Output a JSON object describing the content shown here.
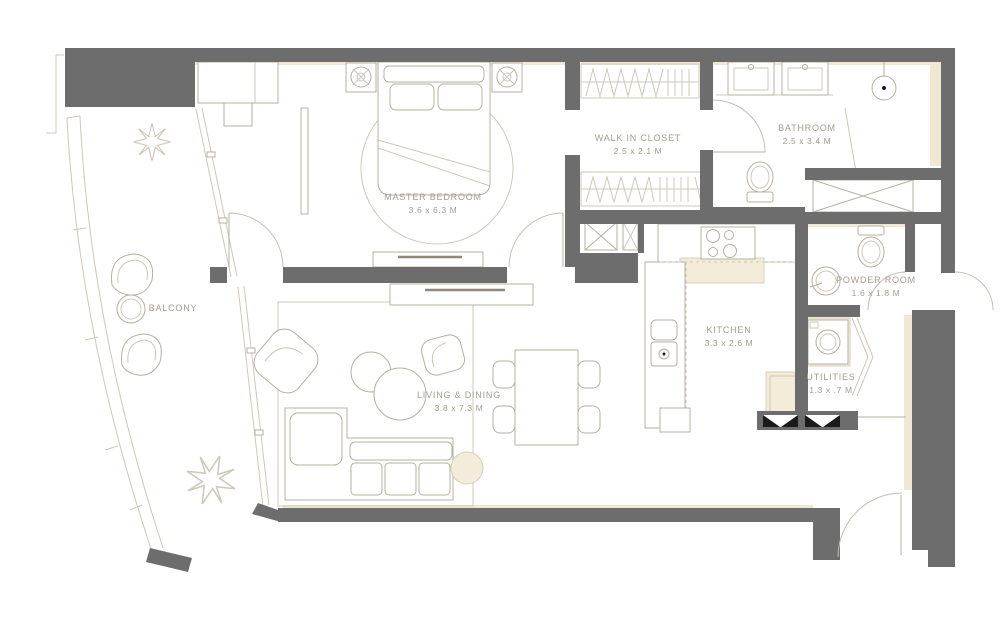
{
  "plan": {
    "title": "apartment-floor-plan",
    "rooms": [
      {
        "id": "master-bedroom",
        "label": "MASTER BEDROOM",
        "dims": "3.6 x 6.3 M"
      },
      {
        "id": "walk-in-closet",
        "label": "WALK IN CLOSET",
        "dims": "2.5 x 2.1 M"
      },
      {
        "id": "bathroom",
        "label": "BATHROOM",
        "dims": "2.5 x 3.4 M"
      },
      {
        "id": "powder-room",
        "label": "POWDER ROOM",
        "dims": "1.6 x 1.8 M"
      },
      {
        "id": "kitchen",
        "label": "KITCHEN",
        "dims": "3.3 x 2.6 M"
      },
      {
        "id": "utilities",
        "label": "UTILITIES",
        "dims": "1.3 x .7 M"
      },
      {
        "id": "living-dining",
        "label": "LIVING & DINING",
        "dims": "3.8 x 7.3 M"
      },
      {
        "id": "balcony",
        "label": "BALCONY",
        "dims": ""
      }
    ],
    "colors": {
      "wall": "#6d6d6d",
      "furniture_outline": "#b7b0a0",
      "soft_shadow": "#f0e8d2",
      "label_text": "#a49d90",
      "threshold_black": "#1a1a1a",
      "background": "#ffffff"
    }
  }
}
